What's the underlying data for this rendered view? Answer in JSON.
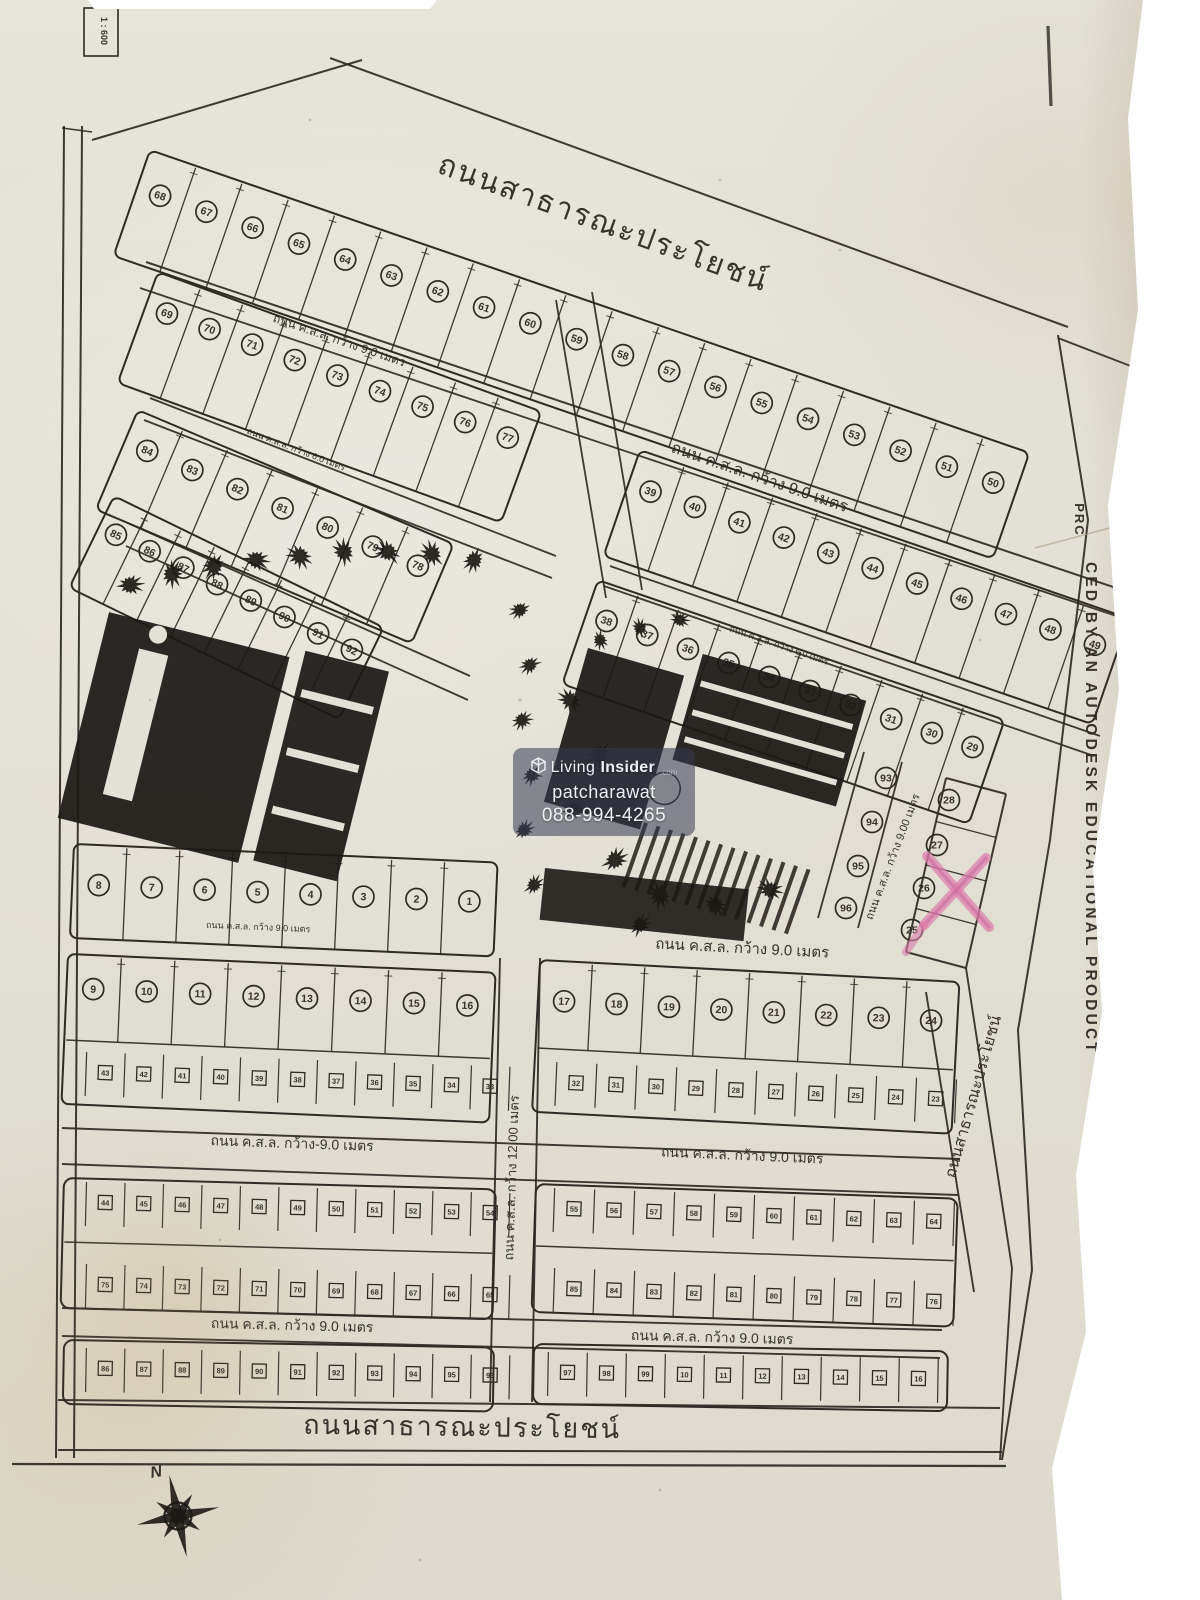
{
  "photo": {
    "description": "Photographed Thai land subdivision plat map on wooden table",
    "paper_color": "#e3e0d5",
    "ink_color": "#2e2a24",
    "wood_color": "#6b4f33",
    "marker_color": "#df7fae"
  },
  "labels": {
    "top_road": "ถนนสาธารณะประโยชน์",
    "bottom_road": "ถนนสาธารณะประโยชน์",
    "right_road": "ถนนสาธารณะประโยชน์",
    "road_w9": "ถนน ค.ส.ล. กว้าง 9.0 เมตร",
    "road_w9_dash": "ถนน ค.ส.ล. กว้าง-9.0 เมตร",
    "road_w9_00": "ถนน ค.ส.ล. กว้าง 9.00 เมตร",
    "road_w12": "ถนน ค.ส.ล. กว้าง 12.00 เมตร",
    "road_w6": "ถนน ค.ส.ล. กว้าง 6.0 เมตร",
    "scale": "1 : 600",
    "north": "N",
    "autodesk_top": "PRC",
    "autodesk_main": "CED BY AN AUTODESK EDUCATIONAL PRODUCT"
  },
  "watermark": {
    "brand_living": "Living",
    "brand_insider": "Insider",
    "brand_com": ".com",
    "name": "patcharawat",
    "phone": "088-994-4265"
  },
  "marked_lot": "26",
  "blocks": {
    "north_strip": [
      68,
      67,
      66,
      65,
      64,
      63,
      62,
      61,
      60,
      59,
      58,
      57,
      56,
      55,
      54,
      53,
      52,
      51,
      50
    ],
    "row_69_77": [
      69,
      70,
      71,
      72,
      73,
      74,
      75,
      76,
      77
    ],
    "row_39_49": [
      39,
      40,
      41,
      42,
      43,
      44,
      45,
      46,
      47,
      48,
      49
    ],
    "row_38_29": [
      38,
      37,
      36,
      35,
      34,
      33,
      32,
      31,
      30,
      29
    ],
    "row_84_78": [
      84,
      83,
      82,
      81,
      80,
      79,
      78
    ],
    "row_85_92": [
      85,
      86,
      87,
      88,
      89,
      90,
      91,
      92
    ],
    "col_93_96": [
      93,
      94,
      95,
      96
    ],
    "col_28_25": [
      28,
      27,
      26,
      25
    ],
    "row_17_24": [
      17,
      18,
      19,
      20,
      21,
      22,
      23,
      24
    ],
    "row_8_1": [
      8,
      7,
      6,
      5,
      4,
      3,
      2,
      1
    ],
    "row_9_16": [
      9,
      10,
      11,
      12,
      13,
      14,
      15,
      16
    ]
  },
  "phase2_lot_numbers_approx": {
    "approx": true,
    "a1l": [
      "43",
      "42",
      "41",
      "40",
      "39",
      "38",
      "37",
      "36",
      "35",
      "34",
      "33"
    ],
    "a1r": [
      "32",
      "31",
      "30",
      "29",
      "28",
      "27",
      "26",
      "25",
      "24",
      "23"
    ],
    "b1l": [
      "44",
      "45",
      "46",
      "47",
      "48",
      "49",
      "50",
      "51",
      "52",
      "53",
      "54"
    ],
    "b1r": [
      "55",
      "56",
      "57",
      "58",
      "59",
      "60",
      "61",
      "62",
      "63",
      "64"
    ],
    "b2l": [
      "75",
      "74",
      "73",
      "72",
      "71",
      "70",
      "69",
      "68",
      "67",
      "66",
      "65"
    ],
    "b2r": [
      "85",
      "84",
      "83",
      "82",
      "81",
      "80",
      "79",
      "78",
      "77",
      "76"
    ],
    "c1l": [
      "86",
      "87",
      "88",
      "89",
      "90",
      "91",
      "92",
      "93",
      "94",
      "95",
      "96"
    ],
    "c1r": [
      "97",
      "98",
      "99",
      "10",
      "11",
      "12",
      "13",
      "14",
      "15",
      "16"
    ]
  }
}
